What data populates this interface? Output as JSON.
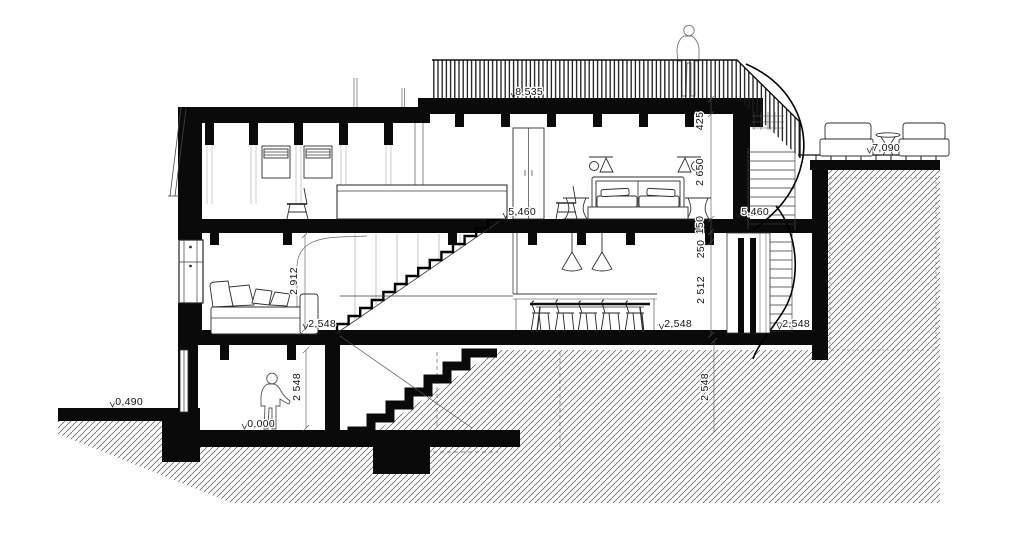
{
  "levels": {
    "roof": "8,535",
    "upper_left": "5,460",
    "upper_right": "5,460",
    "mid_left": "2,548",
    "mid_center": "2,548",
    "mid_right": "2,548",
    "lower": "0,000",
    "ground_left": "0,490",
    "terrace": "7,090"
  },
  "dimensions": {
    "roof_parapet": "425",
    "bedroom_height": "2 650",
    "upper_floor_thickness": "150",
    "door_head": "250",
    "door_height": "2 512",
    "living_height": "2 912",
    "lower_room_height": "2 548",
    "ground_right_depth": "2 548"
  },
  "colors": {
    "ink": "#0a0a0a",
    "thin_line": "#444444",
    "background": "#ffffff"
  }
}
